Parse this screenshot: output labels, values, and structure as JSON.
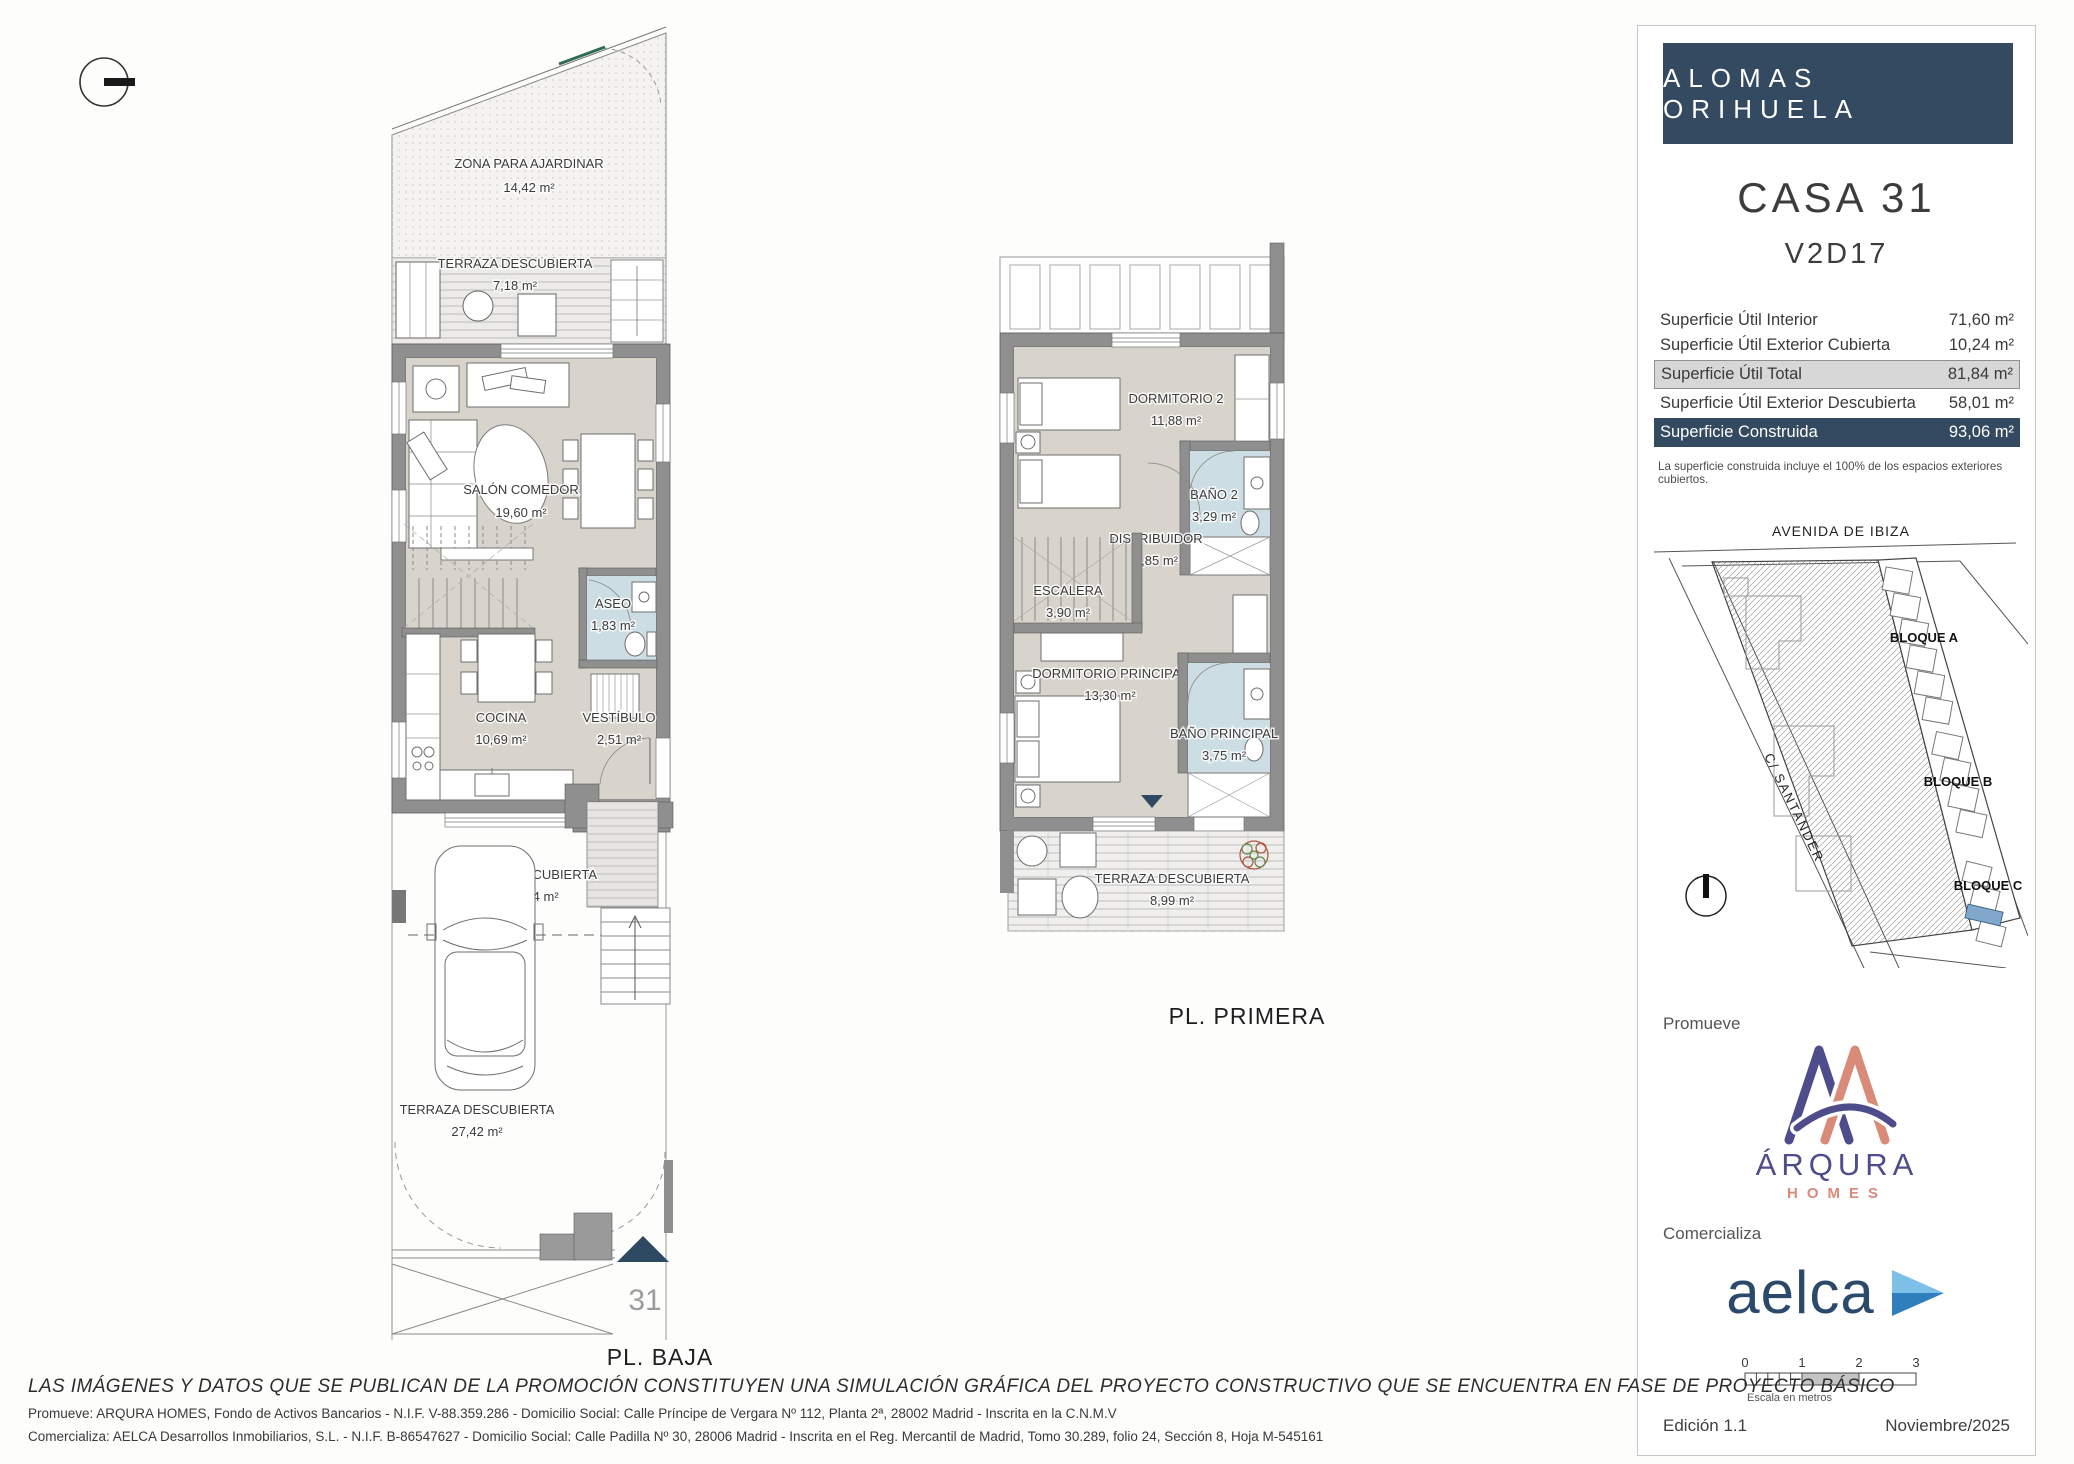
{
  "plans": {
    "baja": {
      "label": "PL. BAJA",
      "unit_number": "31",
      "rooms": {
        "jardin": {
          "name": "ZONA PARA AJARDINAR",
          "area": "14,42 m²"
        },
        "terraza_sup": {
          "name": "TERRAZA DESCUBIERTA",
          "area": "7,18 m²"
        },
        "salon": {
          "name": "SALÓN COMEDOR",
          "area": "19,60 m²"
        },
        "aseo": {
          "name": "ASEO",
          "area": "1,83 m²"
        },
        "cocina": {
          "name": "COCINA",
          "area": "10,69 m²"
        },
        "vestibulo": {
          "name": "VESTÍBULO",
          "area": "2,51 m²"
        },
        "terraza_cub": {
          "name": "TERRAZA CUBIERTA",
          "area": "10,24 m²"
        },
        "terraza_inf": {
          "name": "TERRAZA DESCUBIERTA",
          "area": "27,42 m²"
        }
      }
    },
    "primera": {
      "label": "PL. PRIMERA",
      "rooms": {
        "dormitorio2": {
          "name": "DORMITORIO 2",
          "area": "11,88 m²"
        },
        "bano2": {
          "name": "BAÑO 2",
          "area": "3,29 m²"
        },
        "distribuidor": {
          "name": "DISTRIBUIDOR",
          "area": "0,85 m²"
        },
        "escalera": {
          "name": "ESCALERA",
          "area": "3,90 m²"
        },
        "dormitorio_p": {
          "name": "DORMITORIO PRINCIPAL",
          "area": "13,30 m²"
        },
        "bano_p": {
          "name": "BAÑO PRINCIPAL",
          "area": "3,75 m²"
        },
        "terraza": {
          "name": "TERRAZA DESCUBIERTA",
          "area": "8,99 m²"
        }
      }
    }
  },
  "panel": {
    "project_title": "ALOMAS ORIHUELA",
    "unit_title": "CASA 31",
    "unit_code": "V2D17",
    "surfaces": {
      "rows": [
        {
          "label": "Superficie Útil Interior",
          "value": "71,60 m²"
        },
        {
          "label": "Superficie Útil Exterior Cubierta",
          "value": "10,24 m²"
        },
        {
          "label": "Superficie Útil Total",
          "value": "81,84 m²"
        },
        {
          "label": "Superficie Útil Exterior Descubierta",
          "value": "58,01 m²"
        },
        {
          "label": "Superficie Construida",
          "value": "93,06 m²"
        }
      ],
      "note": "La superficie construida incluye el 100% de los espacios exteriores cubiertos."
    },
    "map": {
      "street_top": "AVENIDA DE IBIZA",
      "street_left": "C/ SANTANDER",
      "block_a": "BLOQUE A",
      "block_b": "BLOQUE B",
      "block_c": "BLOQUE C"
    },
    "promueve_label": "Promueve",
    "promoter": {
      "name": "ÁRQURA",
      "sub": "HOMES"
    },
    "comercializa_label": "Comercializa",
    "agency": {
      "name": "aelca"
    },
    "scale_bar": {
      "t0": "0",
      "t1": "1",
      "t2": "2",
      "t3": "3",
      "caption": "Escala en metros"
    },
    "edition": "Edición 1.1",
    "date": "Noviembre/2025"
  },
  "footer": {
    "disclaimer": "LAS IMÁGENES Y DATOS QUE SE PUBLICAN DE LA PROMOCIÓN CONSTITUYEN UNA SIMULACIÓN GRÁFICA DEL PROYECTO CONSTRUCTIVO QUE SE ENCUENTRA EN FASE DE PROYECTO BÁSICO",
    "promueve": "Promueve: ARQURA HOMES, Fondo de Activos Bancarios - N.I.F. V-88.359.286 - Domicilio Social: Calle Príncipe de Vergara Nº 112, Planta 2ª, 28002 Madrid - Inscrita en la C.N.M.V",
    "comercializa": "Comercializa: AELCA Desarrollos Inmobiliarios, S.L. - N.I.F. B-86547627 - Domicilio Social: Calle Padilla Nº 30, 28006 Madrid - Inscrita en el Reg. Mercantil de Madrid, Tomo 30.289, folio 24, Sección 8, Hoja M-545161"
  },
  "colors": {
    "navy": "#344a61",
    "wall_gray": "#8f8f8f",
    "floor_beige": "#d8d4cb",
    "bath_blue": "#ccdde3",
    "map_unit_blue": "#7fa8cc",
    "arqura_purple": "#4e4d8c",
    "arqura_salmon": "#d98a78",
    "aelca_navy": "#2b4a6b",
    "aelca_blue_light": "#7cc0e8",
    "aelca_blue_dark": "#2f7fbd"
  }
}
